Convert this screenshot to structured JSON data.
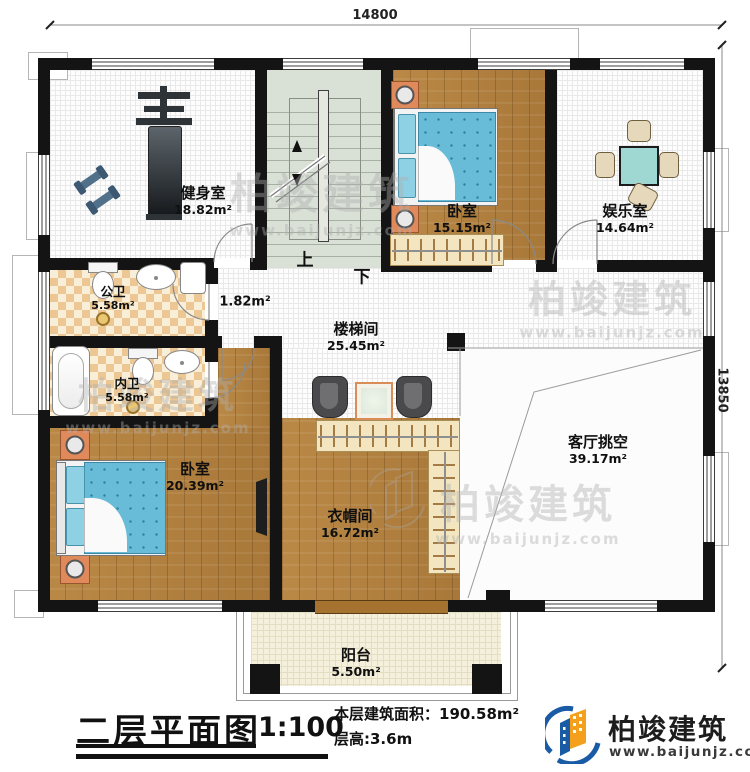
{
  "dims": {
    "width_label": "14800",
    "height_label": "13850"
  },
  "rooms": [
    {
      "id": "gym",
      "name": "健身室",
      "area": "18.82m²"
    },
    {
      "id": "bedroom_top",
      "name": "卧室",
      "area": "15.15m²"
    },
    {
      "id": "entertainment",
      "name": "娱乐室",
      "area": "14.64m²"
    },
    {
      "id": "public_bath",
      "name": "公卫",
      "area": "5.58m²"
    },
    {
      "id": "stair_hall",
      "name": "楼梯间",
      "area": "25.45m²"
    },
    {
      "id": "hall_nook",
      "name": "",
      "area": "1.82m²"
    },
    {
      "id": "private_bath",
      "name": "内卫",
      "area": "5.58m²"
    },
    {
      "id": "bedroom_main",
      "name": "卧室",
      "area": "20.39m²"
    },
    {
      "id": "cloakroom",
      "name": "衣帽间",
      "area": "16.72m²"
    },
    {
      "id": "living_void",
      "name": "客厅挑空",
      "area": "39.17m²"
    },
    {
      "id": "balcony",
      "name": "阳台",
      "area": "5.50m²"
    }
  ],
  "stairs": {
    "up_label": "上",
    "down_label": "下"
  },
  "titleblock": {
    "title": "二层平面图",
    "scale": "1:100",
    "area_line": "本层建筑面积：190.58m²",
    "height_line": "层高:3.6m"
  },
  "brand": {
    "name": "柏竣建筑",
    "site": "www.baijunjz.com"
  },
  "watermark": {
    "text": "柏竣建筑",
    "site": "www.baijunjz.com"
  },
  "colors": {
    "wall": "#141414",
    "wood": "#b1803f",
    "bed": "#68bcd8",
    "accent_orange": "#f5a01d",
    "accent_blue": "#1a5ba6"
  }
}
